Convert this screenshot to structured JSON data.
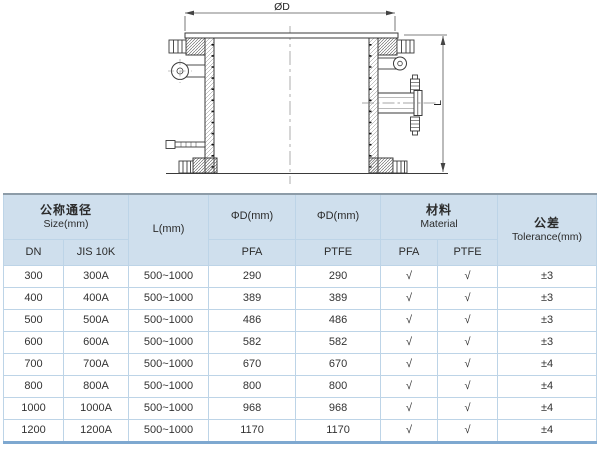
{
  "drawing": {
    "dim_diameter_label": "ØD",
    "dim_length_label": "L"
  },
  "table": {
    "header": {
      "size_group": {
        "zh": "公称通径",
        "en": "Size(mm)"
      },
      "sub_dn": "DN",
      "sub_jis": "JIS 10K",
      "l_col": "L(mm)",
      "d_pfa_col": "ΦD(mm)",
      "d_ptfe_col": "ΦD(mm)",
      "sub_pfa_d": "PFA",
      "sub_ptfe_d": "PTFE",
      "material_group": {
        "zh": "材料",
        "en": "Material"
      },
      "sub_pfa_m": "PFA",
      "sub_ptfe_m": "PTFE",
      "tolerance_col": {
        "zh": "公差",
        "en": "Tolerance(mm)"
      }
    },
    "rows": [
      [
        "300",
        "300A",
        "500~1000",
        "290",
        "290",
        "√",
        "√",
        "±3"
      ],
      [
        "400",
        "400A",
        "500~1000",
        "389",
        "389",
        "√",
        "√",
        "±3"
      ],
      [
        "500",
        "500A",
        "500~1000",
        "486",
        "486",
        "√",
        "√",
        "±3"
      ],
      [
        "600",
        "600A",
        "500~1000",
        "582",
        "582",
        "√",
        "√",
        "±3"
      ],
      [
        "700",
        "700A",
        "500~1000",
        "670",
        "670",
        "√",
        "√",
        "±4"
      ],
      [
        "800",
        "800A",
        "500~1000",
        "800",
        "800",
        "√",
        "√",
        "±4"
      ],
      [
        "1000",
        "1000A",
        "500~1000",
        "968",
        "968",
        "√",
        "√",
        "±4"
      ],
      [
        "1200",
        "1200A",
        "500~1000",
        "1170",
        "1170",
        "√",
        "√",
        "±4"
      ]
    ]
  },
  "colors": {
    "header_bg": "#cfdfed",
    "grid_line": "#bdd4e7",
    "table_top_border": "#8d9ca8",
    "table_bottom_border": "#7ea8d0",
    "drawing_line": "#3a3a3a"
  }
}
